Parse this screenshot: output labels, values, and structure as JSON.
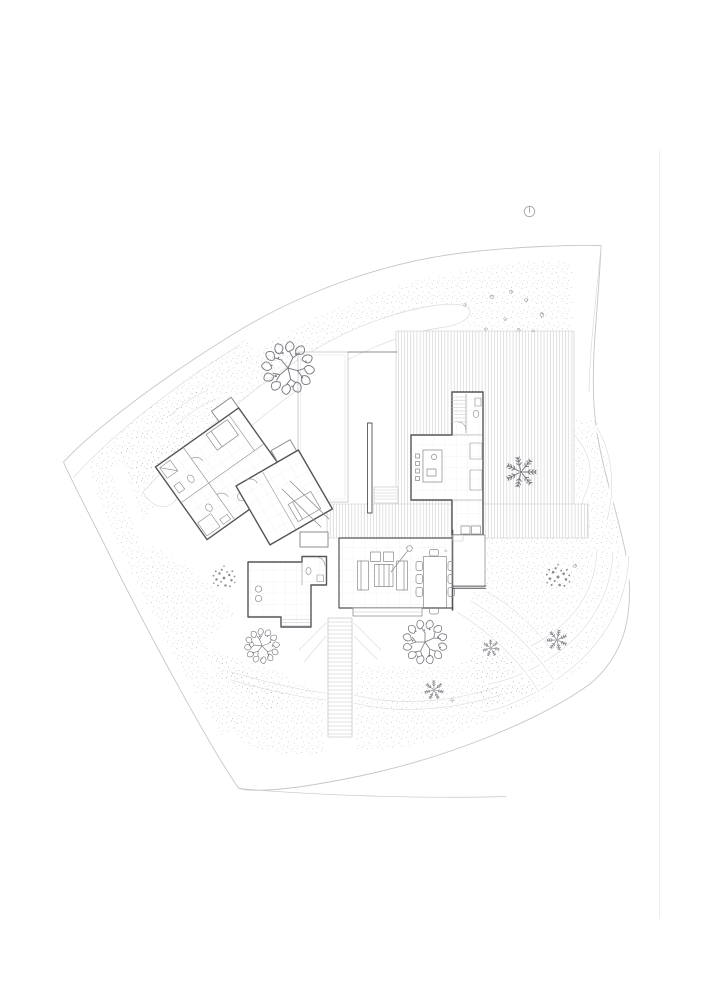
{
  "page": {
    "width": "706",
    "height": "1000",
    "background": "#ffffff"
  },
  "drawing": {
    "label": "Black-and-white architectural site plan of a single-storey house with landscaped grounds, timber decks, garden stair and trees",
    "title": "Site plan — ground floor",
    "north_symbol": "small circle with north tick",
    "colors": {
      "paper": "#ffffff",
      "boundary": "#c6c6c9",
      "path": "#d8d8db",
      "stipple": "#98989c",
      "deck": "#c8c8cb",
      "wall": "#55555a",
      "wall-mid": "#8e8e92",
      "wall-light": "#c4c4c7",
      "grid": "#f0f0f2",
      "furniture": "#8a8a8e",
      "tree": "#797980",
      "shrub": "#88888d",
      "north": "#a6a6ab",
      "sheet-edge": "#ededef"
    },
    "areas": {
      "site": "irregular walled garden plot with stippled planting bands",
      "bedroom_wing": "rotated bedroom wing with two bedrooms and bathrooms",
      "kitchen_wing": "kitchen wing with island, stair and bathroom",
      "living_pavilion": "living and dining pavilion with sofas, coffee table and table for eight",
      "garage_studio": "detached studio with washroom",
      "courtyard": "walled courtyard terrace with blade wall and steps",
      "deck": "timber deck",
      "walkway": "decked walkway",
      "stairs": "long exterior garden stair"
    },
    "landscape": {
      "deciduous_trees": 3,
      "spiky_trees": 4,
      "round_bushes": 2,
      "small_shrubs": 9
    }
  }
}
